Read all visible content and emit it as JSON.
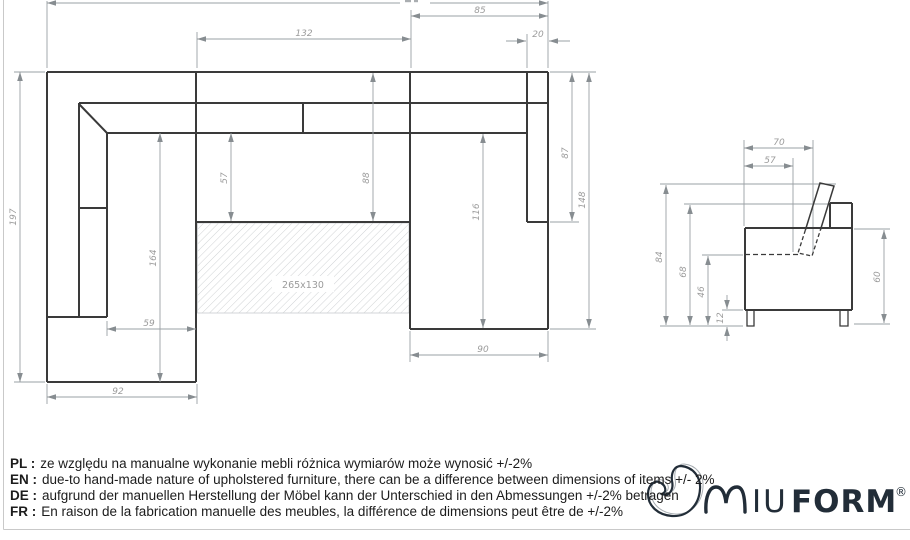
{
  "top_view_dims": {
    "overall": "",
    "w85": "85",
    "w132": "132",
    "w20": "20",
    "h197": "197",
    "h164": "164",
    "h57": "57",
    "h88": "88",
    "h116": "116",
    "h87": "87",
    "h148": "148",
    "w59": "59",
    "w92": "92",
    "w90": "90",
    "mattress": "265x130"
  },
  "side_view_dims": {
    "w70": "70",
    "w57": "57",
    "h84": "84",
    "h68": "68",
    "h46": "46",
    "h12": "12",
    "h60": "60"
  },
  "notes": [
    {
      "prefix": "PL :",
      "text": "ze względu na manualne wykonanie mebli różnica wymiarów może wynosić +/-2%"
    },
    {
      "prefix": "EN :",
      "text": "due-to hand-made nature of upholstered furniture, there can be a difference between dimensions of items +/- 2%"
    },
    {
      "prefix": "DE :",
      "text": "aufgrund der manuellen Herstellung der Möbel kann der Unterschied in den Abmessungen +/-2% betragen"
    },
    {
      "prefix": "FR :",
      "text": "En raison de la fabrication manuelle des meubles, la différence de dimensions peut être de +/-2%"
    }
  ],
  "logo": {
    "brand": "MIUFORM",
    "iu": "IU",
    "form": "FORM",
    "registered": "®"
  },
  "colors": {
    "line_bold": "#3a3a3a",
    "line_dim": "#9aa0a4",
    "dim_text": "#9b9b9b",
    "logo": "#222d38",
    "note_text": "#1c1c1c"
  }
}
